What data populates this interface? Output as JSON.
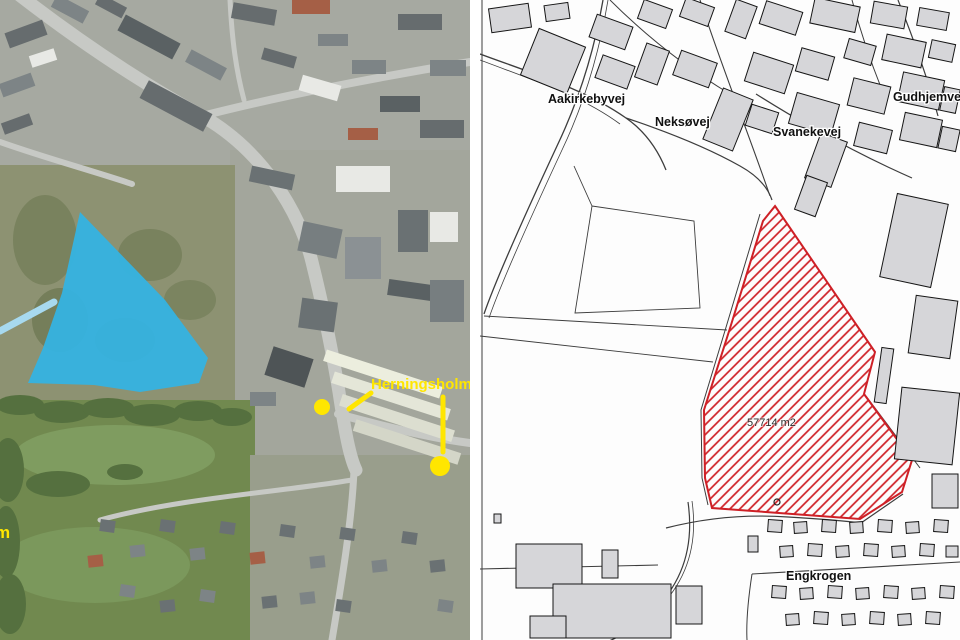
{
  "left_panel": {
    "type": "aerial-photo",
    "base_color": "#9aa08f",
    "regions": [
      [
        0,
        0,
        470,
        185,
        "#a6a9a1"
      ],
      [
        230,
        150,
        240,
        325,
        "#a3a69c"
      ],
      [
        0,
        165,
        235,
        250,
        "#8d9272"
      ],
      [
        0,
        400,
        255,
        240,
        "#71894f"
      ],
      [
        250,
        455,
        220,
        185,
        "#999e8c"
      ]
    ],
    "patches": [
      [
        115,
        455,
        100,
        30,
        "#7f9c60"
      ],
      [
        95,
        565,
        95,
        38,
        "#7b985c"
      ],
      [
        45,
        240,
        32,
        45,
        "#79825e"
      ],
      [
        150,
        255,
        32,
        26,
        "#79825e"
      ],
      [
        125,
        340,
        30,
        22,
        "#757e5a"
      ],
      [
        190,
        300,
        26,
        20,
        "#7b8460"
      ],
      [
        60,
        320,
        28,
        32,
        "#757e5a"
      ]
    ],
    "road_color": "#c7c9c5",
    "roads": [
      [
        "M18,-6 C80,42 140,82 202,116 C262,150 300,212 312,262 C322,302 331,345 339,392 C345,432 350,458 356,470",
        13
      ],
      [
        "M202,116 C280,96 382,76 470,62",
        8
      ],
      [
        "M338,414 C382,426 432,438 470,443",
        8
      ],
      [
        "M354,470 C352,520 342,580 332,640",
        7
      ],
      [
        "M0,142 C45,158 90,170 132,184",
        6
      ],
      [
        "M230,0 C232,40 236,70 244,100",
        5
      ],
      [
        "M352,480 C280,492 180,498 100,520",
        5
      ]
    ],
    "buildings": [
      [
        6,
        26,
        40,
        16,
        -20,
        "#666c6e"
      ],
      [
        0,
        78,
        34,
        14,
        -20,
        "#7d8486"
      ],
      [
        2,
        118,
        30,
        12,
        -20,
        "#666c6e"
      ],
      [
        52,
        2,
        36,
        14,
        28,
        "#7d8486"
      ],
      [
        96,
        0,
        30,
        12,
        28,
        "#666c6e"
      ],
      [
        30,
        52,
        26,
        12,
        -18,
        "#e8e9e5"
      ],
      [
        118,
        28,
        62,
        18,
        28,
        "#5a6163"
      ],
      [
        140,
        96,
        72,
        20,
        28,
        "#666c6e"
      ],
      [
        186,
        58,
        40,
        14,
        28,
        "#7d8486"
      ],
      [
        232,
        6,
        44,
        16,
        10,
        "#666c6e"
      ],
      [
        292,
        0,
        38,
        14,
        0,
        "#a55f46"
      ],
      [
        318,
        34,
        30,
        12,
        0,
        "#7d8486"
      ],
      [
        262,
        52,
        34,
        12,
        16,
        "#666c6e"
      ],
      [
        300,
        80,
        40,
        16,
        16,
        "#e8e9e5"
      ],
      [
        352,
        60,
        34,
        14,
        0,
        "#7d8486"
      ],
      [
        398,
        14,
        44,
        16,
        0,
        "#666c6e"
      ],
      [
        430,
        60,
        36,
        16,
        0,
        "#7d8486"
      ],
      [
        380,
        96,
        40,
        16,
        0,
        "#5a6163"
      ],
      [
        420,
        120,
        44,
        18,
        0,
        "#666c6e"
      ],
      [
        348,
        128,
        30,
        12,
        0,
        "#a55f46"
      ],
      [
        250,
        170,
        44,
        16,
        12,
        "#6a7173"
      ],
      [
        336,
        166,
        54,
        26,
        0,
        "#e8e9e5"
      ],
      [
        300,
        225,
        40,
        30,
        12,
        "#777e80"
      ],
      [
        345,
        237,
        36,
        42,
        0,
        "#8b9194"
      ],
      [
        398,
        210,
        30,
        42,
        0,
        "#6a7173"
      ],
      [
        430,
        212,
        28,
        30,
        0,
        "#e8e9e5"
      ],
      [
        388,
        282,
        44,
        16,
        8,
        "#5a6163"
      ],
      [
        300,
        300,
        36,
        30,
        8,
        "#6a7173"
      ],
      [
        430,
        280,
        34,
        42,
        0,
        "#777e80"
      ],
      [
        268,
        352,
        42,
        30,
        18,
        "#4e5456"
      ],
      [
        322,
        368,
        122,
        12,
        18,
        "#eceede"
      ],
      [
        330,
        390,
        122,
        12,
        18,
        "#e4e6d8"
      ],
      [
        338,
        412,
        118,
        12,
        18,
        "#dcded0"
      ],
      [
        352,
        436,
        110,
        12,
        18,
        "#d4d6c8"
      ],
      [
        250,
        392,
        26,
        14,
        0,
        "#7d8486"
      ],
      [
        100,
        520,
        15,
        12,
        8,
        "#6a7173"
      ],
      [
        130,
        545,
        15,
        12,
        -6,
        "#7d8486"
      ],
      [
        160,
        520,
        15,
        12,
        8,
        "#6a7173"
      ],
      [
        190,
        548,
        15,
        12,
        -6,
        "#7d8486"
      ],
      [
        220,
        522,
        15,
        12,
        8,
        "#6a7173"
      ],
      [
        250,
        552,
        15,
        12,
        -6,
        "#a55f46"
      ],
      [
        280,
        525,
        15,
        12,
        8,
        "#6a7173"
      ],
      [
        310,
        556,
        15,
        12,
        -6,
        "#7d8486"
      ],
      [
        340,
        528,
        15,
        12,
        8,
        "#6a7173"
      ],
      [
        372,
        560,
        15,
        12,
        -6,
        "#7d8486"
      ],
      [
        402,
        532,
        15,
        12,
        8,
        "#6a7173"
      ],
      [
        300,
        592,
        15,
        12,
        -6,
        "#7d8486"
      ],
      [
        336,
        600,
        15,
        12,
        8,
        "#6a7173"
      ],
      [
        262,
        596,
        15,
        12,
        -6,
        "#6a7173"
      ],
      [
        200,
        590,
        15,
        12,
        8,
        "#7d8486"
      ],
      [
        160,
        600,
        15,
        12,
        -6,
        "#6a7173"
      ],
      [
        120,
        585,
        15,
        12,
        8,
        "#7d8486"
      ],
      [
        430,
        560,
        15,
        12,
        -6,
        "#6a7173"
      ],
      [
        438,
        600,
        15,
        12,
        8,
        "#7d8486"
      ],
      [
        88,
        555,
        15,
        12,
        -6,
        "#a55f46"
      ]
    ],
    "tree_color": "#55703f",
    "trees": [
      [
        20,
        405,
        24,
        10
      ],
      [
        62,
        412,
        28,
        11
      ],
      [
        108,
        408,
        26,
        10
      ],
      [
        152,
        415,
        28,
        11
      ],
      [
        198,
        411,
        24,
        10
      ],
      [
        232,
        417,
        20,
        9
      ],
      [
        8,
        470,
        16,
        32
      ],
      [
        6,
        542,
        14,
        36
      ],
      [
        10,
        604,
        16,
        30
      ],
      [
        58,
        484,
        32,
        13
      ],
      [
        125,
        472,
        18,
        8
      ]
    ],
    "highlight_polygon": {
      "color": "#35b3e2",
      "opacity": 0.95,
      "points": "80,212 165,300 208,358 199,383 140,392 94,385 28,383 43,348 62,293"
    },
    "leader_line_blue": {
      "x1": 0,
      "y1": 331,
      "x2": 54,
      "y2": 302,
      "color": "#a7d9ef",
      "width": 7
    },
    "annotations": {
      "label": "Herningsholm",
      "partial_label": "m",
      "color": "#ffe600",
      "lines": [
        [
          349,
          409,
          371,
          393
        ],
        [
          443,
          397,
          443,
          452
        ]
      ],
      "dots": [
        [
          322,
          407,
          8
        ],
        [
          440,
          466,
          10
        ]
      ]
    }
  },
  "right_panel": {
    "type": "cadastral-map",
    "background": "#fdfdfd",
    "line_color": "#3d3d3d",
    "building_fill": "#d6d6d9",
    "building_stroke": "#161616",
    "red": "#ce2026",
    "area_label": "57714 m2",
    "street_labels": {
      "aakirkebyvej": "Aakirkebyvej",
      "neksoevej": "Neksøvej",
      "svanekevej": "Svanekevej",
      "gudhjemvej": "Gudhjemvej",
      "engkrogen": "Engkrogen"
    },
    "parcel": {
      "points": "775,206 875,352 864,394 912,460 902,492 860,519 712,508 705,478 704,410 731,325 763,221",
      "hatch_spacing": 7,
      "hatch_width": 1.7,
      "outline_width": 2
    },
    "point_symbol": {
      "cx": 777,
      "cy": 502,
      "r": 3
    },
    "lines": [
      [
        "M603,0 C594,52 578,102 557,146 C530,204 497,276 484,314",
        1.3
      ],
      [
        "M608,0 C599,54 583,106 562,150 C535,208 502,280 489,318",
        0.8
      ],
      [
        "M480,54 C540,76 586,90 626,118 C646,132 658,150 666,170",
        1.3
      ],
      [
        "M480,60 C538,82 582,96 620,124",
        0.8
      ],
      [
        "M626,118 C668,132 708,148 740,166 C758,176 768,188 772,200",
        1.2
      ],
      [
        "M700,0 C720,62 748,132 770,196",
        1.1
      ],
      [
        "M610,0 C650,40 690,70 730,94",
        1.0
      ],
      [
        "M756,94 C810,128 862,156 912,178",
        1.2
      ],
      [
        "M898,0 C914,40 928,80 938,116",
        1.2
      ],
      [
        "M852,0 C860,30 870,60 882,90",
        1.0
      ],
      [
        "M484,316 L727,330",
        0.9
      ],
      [
        "M592,206 L694,221 L700,308 L575,313 Z",
        0.9
      ],
      [
        "M592,206 L574,166",
        0.9
      ],
      [
        "M480,336 L713,362",
        0.9
      ],
      [
        "M480,569 L658,565",
        1.1
      ],
      [
        "M666,528 C705,518 745,514 788,517 C822,519 846,521 861,523 L903,494",
        1.2
      ],
      [
        "M866,396 L920,468",
        1.0
      ],
      [
        "M688,502 C694,544 684,582 652,612 C636,628 618,638 606,642",
        1.2
      ],
      [
        "M692,501 C698,543 688,580 657,610",
        0.8
      ],
      [
        "M752,574 L960,562",
        1.1
      ],
      [
        "M752,574 C748,600 746,620 747,640",
        1.0
      ],
      [
        "M760,214 L727,324 L701,410 L702,478 L708,505",
        1.0
      ],
      [
        "M482,0 L482,640",
        1.0
      ]
    ],
    "buildings": [
      [
        490,
        6,
        40,
        24,
        -8
      ],
      [
        545,
        4,
        24,
        16,
        -8
      ],
      [
        592,
        20,
        38,
        24,
        20
      ],
      [
        640,
        4,
        30,
        20,
        20
      ],
      [
        682,
        2,
        30,
        20,
        20
      ],
      [
        528,
        36,
        50,
        50,
        22
      ],
      [
        598,
        60,
        34,
        24,
        20
      ],
      [
        640,
        46,
        24,
        36,
        20
      ],
      [
        676,
        56,
        38,
        26,
        20
      ],
      [
        730,
        2,
        22,
        34,
        20
      ],
      [
        762,
        6,
        38,
        24,
        18
      ],
      [
        812,
        2,
        46,
        26,
        12
      ],
      [
        872,
        4,
        34,
        22,
        10
      ],
      [
        918,
        10,
        30,
        18,
        10
      ],
      [
        712,
        92,
        32,
        55,
        22
      ],
      [
        748,
        58,
        42,
        30,
        18
      ],
      [
        798,
        52,
        34,
        24,
        16
      ],
      [
        846,
        42,
        28,
        20,
        16
      ],
      [
        884,
        38,
        40,
        26,
        12
      ],
      [
        930,
        42,
        24,
        18,
        12
      ],
      [
        748,
        108,
        28,
        22,
        18
      ],
      [
        792,
        98,
        44,
        32,
        16
      ],
      [
        850,
        82,
        38,
        28,
        14
      ],
      [
        900,
        76,
        42,
        30,
        12
      ],
      [
        942,
        88,
        16,
        24,
        12
      ],
      [
        812,
        136,
        28,
        48,
        20
      ],
      [
        800,
        178,
        22,
        36,
        20
      ],
      [
        856,
        126,
        34,
        24,
        14
      ],
      [
        902,
        116,
        38,
        28,
        12
      ],
      [
        940,
        128,
        18,
        22,
        12
      ],
      [
        888,
        198,
        52,
        85,
        12
      ],
      [
        912,
        298,
        42,
        58,
        8
      ],
      [
        878,
        348,
        12,
        55,
        8
      ],
      [
        898,
        390,
        58,
        72,
        6
      ],
      [
        932,
        474,
        26,
        34,
        0
      ],
      [
        516,
        544,
        66,
        44,
        0
      ],
      [
        602,
        550,
        16,
        28,
        0
      ],
      [
        553,
        584,
        118,
        54,
        0
      ],
      [
        676,
        586,
        26,
        38,
        0
      ],
      [
        530,
        616,
        36,
        22,
        0
      ],
      [
        494,
        514,
        7,
        9,
        0
      ],
      [
        768,
        520,
        14,
        12,
        4
      ],
      [
        794,
        522,
        13,
        11,
        -4
      ],
      [
        822,
        520,
        14,
        12,
        4
      ],
      [
        850,
        522,
        13,
        11,
        -4
      ],
      [
        878,
        520,
        14,
        12,
        4
      ],
      [
        906,
        522,
        13,
        11,
        -4
      ],
      [
        934,
        520,
        14,
        12,
        4
      ],
      [
        748,
        536,
        10,
        16,
        0
      ],
      [
        780,
        546,
        13,
        11,
        -4
      ],
      [
        808,
        544,
        14,
        12,
        4
      ],
      [
        836,
        546,
        13,
        11,
        -4
      ],
      [
        864,
        544,
        14,
        12,
        4
      ],
      [
        892,
        546,
        13,
        11,
        -4
      ],
      [
        920,
        544,
        14,
        12,
        4
      ],
      [
        946,
        546,
        12,
        11,
        0
      ],
      [
        772,
        586,
        14,
        12,
        4
      ],
      [
        800,
        588,
        13,
        11,
        -4
      ],
      [
        828,
        586,
        14,
        12,
        4
      ],
      [
        856,
        588,
        13,
        11,
        -4
      ],
      [
        884,
        586,
        14,
        12,
        4
      ],
      [
        912,
        588,
        13,
        11,
        -4
      ],
      [
        940,
        586,
        14,
        12,
        4
      ],
      [
        786,
        614,
        13,
        11,
        -4
      ],
      [
        814,
        612,
        14,
        12,
        4
      ],
      [
        842,
        614,
        13,
        11,
        -4
      ],
      [
        870,
        612,
        14,
        12,
        4
      ],
      [
        898,
        614,
        13,
        11,
        -4
      ],
      [
        926,
        612,
        14,
        12,
        4
      ]
    ]
  }
}
